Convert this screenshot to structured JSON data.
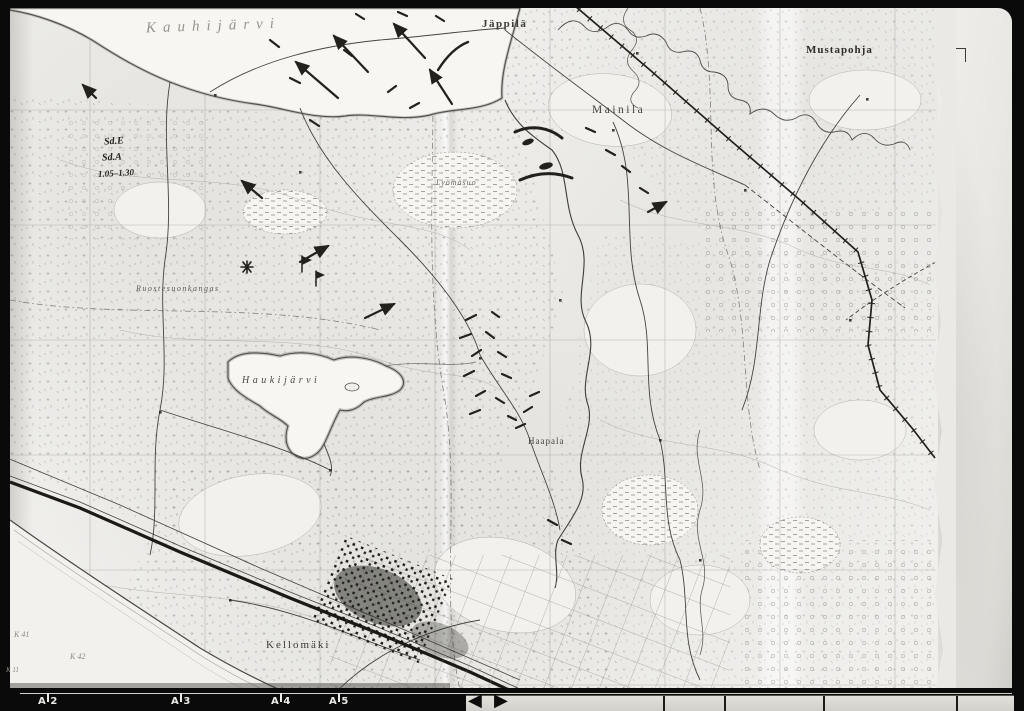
{
  "scan": {
    "background_color": "#0a0a0a",
    "paper_color": "#f0efec",
    "margin_color": "#e9e7e3",
    "ink_color": "#23211c",
    "pencil_color": "#96948a"
  },
  "map_labels": {
    "kauhijarvi_hand": "Kauhijärvi",
    "jappila": "Jäppilä",
    "mainila": "Mainila",
    "mustapohja": "Mustapohja",
    "haukijarvi": "Haukijärvi",
    "haapala": "Haapala",
    "kellomaki": "Kellomäki",
    "ruostesuonkangas": "Ruostesuonkangas",
    "lyomasuo": "Lyömäsuo"
  },
  "handwritten_annotations": {
    "sd_e": "Sd.E",
    "sd_a": "Sd.A",
    "times": "1.05–1.30"
  },
  "water_grid_labels": {
    "k41": "K 41",
    "k42": "K 42",
    "k11": "K 11"
  },
  "ruler": {
    "marks": [
      {
        "letter": "A",
        "number": "2"
      },
      {
        "letter": "A",
        "number": "3"
      },
      {
        "letter": "A",
        "number": "4"
      },
      {
        "letter": "A",
        "number": "5"
      }
    ]
  },
  "icons": {
    "ruler_marker_left": "◀",
    "ruler_marker_right": "▶"
  }
}
